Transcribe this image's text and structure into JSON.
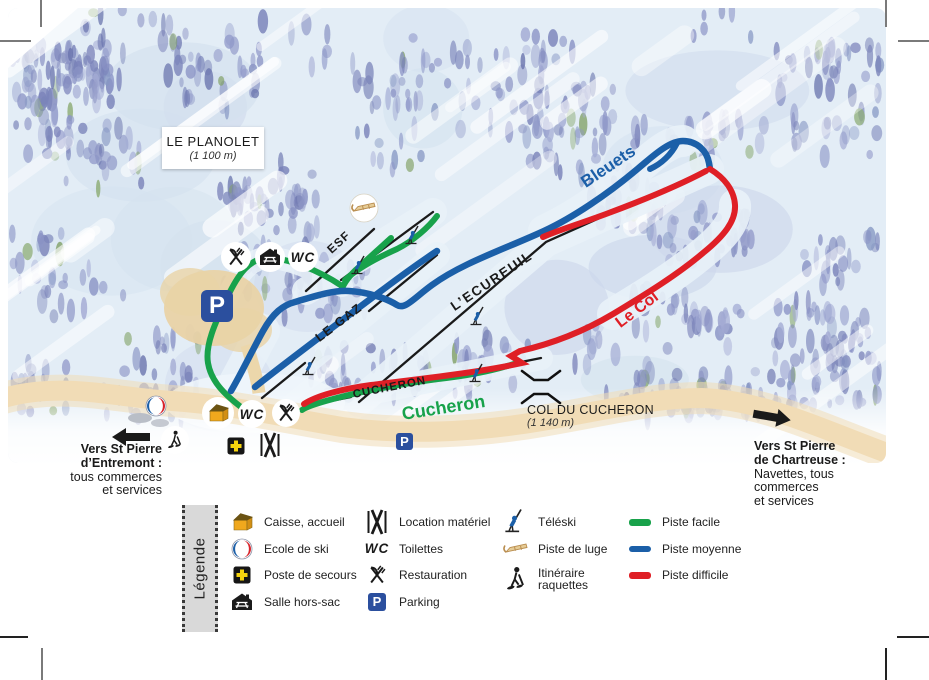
{
  "station": {
    "title": "LE PLANOLET",
    "elevation": "(1 100 m)"
  },
  "col": {
    "title": "COL DU CUCHERON",
    "elevation": "(1 140 m)"
  },
  "lifts": {
    "esf": "ESF",
    "le_gaz": "LE GAZ",
    "ecureuil": "L’ECUREUIL",
    "cucheron": "CUCHERON"
  },
  "pistes": {
    "bleuets": "Bleuets",
    "le_col": "Le Col",
    "cucheron": "Cucheron"
  },
  "markers": {
    "parking": "P",
    "wc": "WC"
  },
  "directions": {
    "west": {
      "line1": "Vers St Pierre",
      "line2": "d’Entremont :",
      "line3": "tous commerces",
      "line4": "et services"
    },
    "east": {
      "line1": "Vers St Pierre",
      "line2": "de Chartreuse :",
      "line3": "Navettes, tous",
      "line4": "commerces",
      "line5": "et services"
    }
  },
  "legend": {
    "title": "Légende",
    "services": [
      {
        "icon": "ticket-house-icon",
        "label": "Caisse, accueil"
      },
      {
        "icon": "ski-school-icon",
        "label": "Ecole de ski"
      },
      {
        "icon": "first-aid-icon",
        "label": "Poste de secours"
      },
      {
        "icon": "picnic-hut-icon",
        "label": "Salle hors-sac"
      }
    ],
    "facilities": [
      {
        "icon": "ski-rental-icon",
        "label": "Location matériel"
      },
      {
        "icon": "toilets-icon",
        "label": "Toilettes"
      },
      {
        "icon": "restaurant-icon",
        "label": "Restauration"
      },
      {
        "icon": "parking-icon",
        "label": "Parking"
      }
    ],
    "activities": [
      {
        "icon": "teleski-icon",
        "label": "Téléski"
      },
      {
        "icon": "sled-icon",
        "label": "Piste de luge"
      },
      {
        "icon": "snowshoe-icon",
        "label": "Itinéraire raquettes"
      }
    ],
    "piste_types": [
      {
        "label": "Piste facile",
        "color": "#18a24b"
      },
      {
        "label": "Piste moyenne",
        "color": "#1b5fa8"
      },
      {
        "label": "Piste difficile",
        "color": "#df1f26"
      }
    ]
  },
  "colors": {
    "piste_facile": "#18a24b",
    "piste_moyenne": "#1b5fa8",
    "piste_difficile": "#df1f26",
    "lift_line": "#1a1a1a",
    "parking_blue": "#2b4f9e",
    "path_tan": "#f1dcb6"
  }
}
